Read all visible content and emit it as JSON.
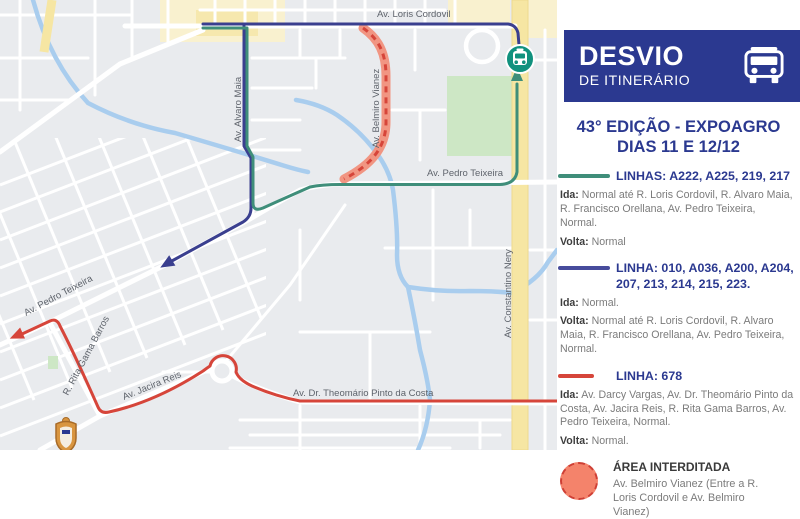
{
  "map": {
    "labels": {
      "loris_cordovil": "Av. Loris Cordovil",
      "alvaro_maia": "Av. Alvaro Maia",
      "belmiro_vianez": "Av. Belmiro Vianez",
      "pedro_teixeira_mid": "Av. Pedro Teixeira",
      "constantino_nery": "Av. Constantino Nery",
      "pedro_teixeira_sw": "Av. Pedro Teixeira",
      "rita_gama_barros": "R. Rita Gama Barros",
      "jacira_reis": "Av. Jacira Reis",
      "theomario": "Av. Dr. Theomário Pinto da Costa"
    },
    "icons": {
      "stop_marker": "bus-stop-marker-icon",
      "crest": "city-crest-icon",
      "green_arrow": "arrow-up",
      "navy_arrow": "arrow-southwest",
      "red_arrow": "arrow-southwest"
    },
    "colors": {
      "map_background": "#E9EBEE",
      "road_white": "#FFFFFF",
      "highlight_road_yellow": "#F6E6A3",
      "commercial_area_yellow": "#F9F1CF",
      "park_green": "#CDE7C5",
      "river_blue": "#A9CDEE",
      "route_green": "#3F8E7A",
      "route_navy": "#3A3F8F",
      "route_red": "#D6453A",
      "closed_band_fill": "#F19582",
      "closed_band_dash": "#D6453A",
      "bus_marker_teal": "#11917E"
    }
  },
  "panel": {
    "header": {
      "title": "DESVIO",
      "subtitle": "DE ITINERÁRIO",
      "icon": "bus-icon",
      "background": "#2B3990"
    },
    "event": {
      "line1": "43° EDIÇÃO - EXPOAGRO",
      "line2": "DIAS 11 E 12/12"
    },
    "sections": [
      {
        "swatch_color": "#3F8E7A",
        "title": "LINHAS: A222, A225, 219, 217",
        "ida_label": "Ida:",
        "ida_text": "Normal até R. Loris Cordovil, R. Alvaro Maia, R. Francisco Orellana, Av. Pedro Teixeira, Normal.",
        "volta_label": "Volta:",
        "volta_text": "Normal"
      },
      {
        "swatch_color": "#474C9C",
        "title": "LINHA: 010, A036, A200, A204, 207, 213, 214, 215, 223.",
        "ida_label": "Ida:",
        "ida_text": "Normal.",
        "volta_label": "Volta:",
        "volta_text": "Normal até R. Loris Cordovil, R. Alvaro Maia, R. Francisco Orellana, Av. Pedro Teixeira, Normal."
      },
      {
        "swatch_color": "#D6453A",
        "title": "LINHA: 678",
        "ida_label": "Ida:",
        "ida_text": "Av. Darcy Vargas, Av. Dr. Theomário Pinto da Costa, Av. Jacira Reis, R. Rita Gama Barros, Av. Pedro Teixeira, Normal.",
        "volta_label": "Volta:",
        "volta_text": "Normal."
      }
    ],
    "closed_area": {
      "icon": "closed-area-circle-icon",
      "title": "ÁREA INTERDITADA",
      "description": "Av. Belmiro Vianez (Entre a R. Loris Cordovil e Av. Belmiro Vianez)"
    }
  }
}
